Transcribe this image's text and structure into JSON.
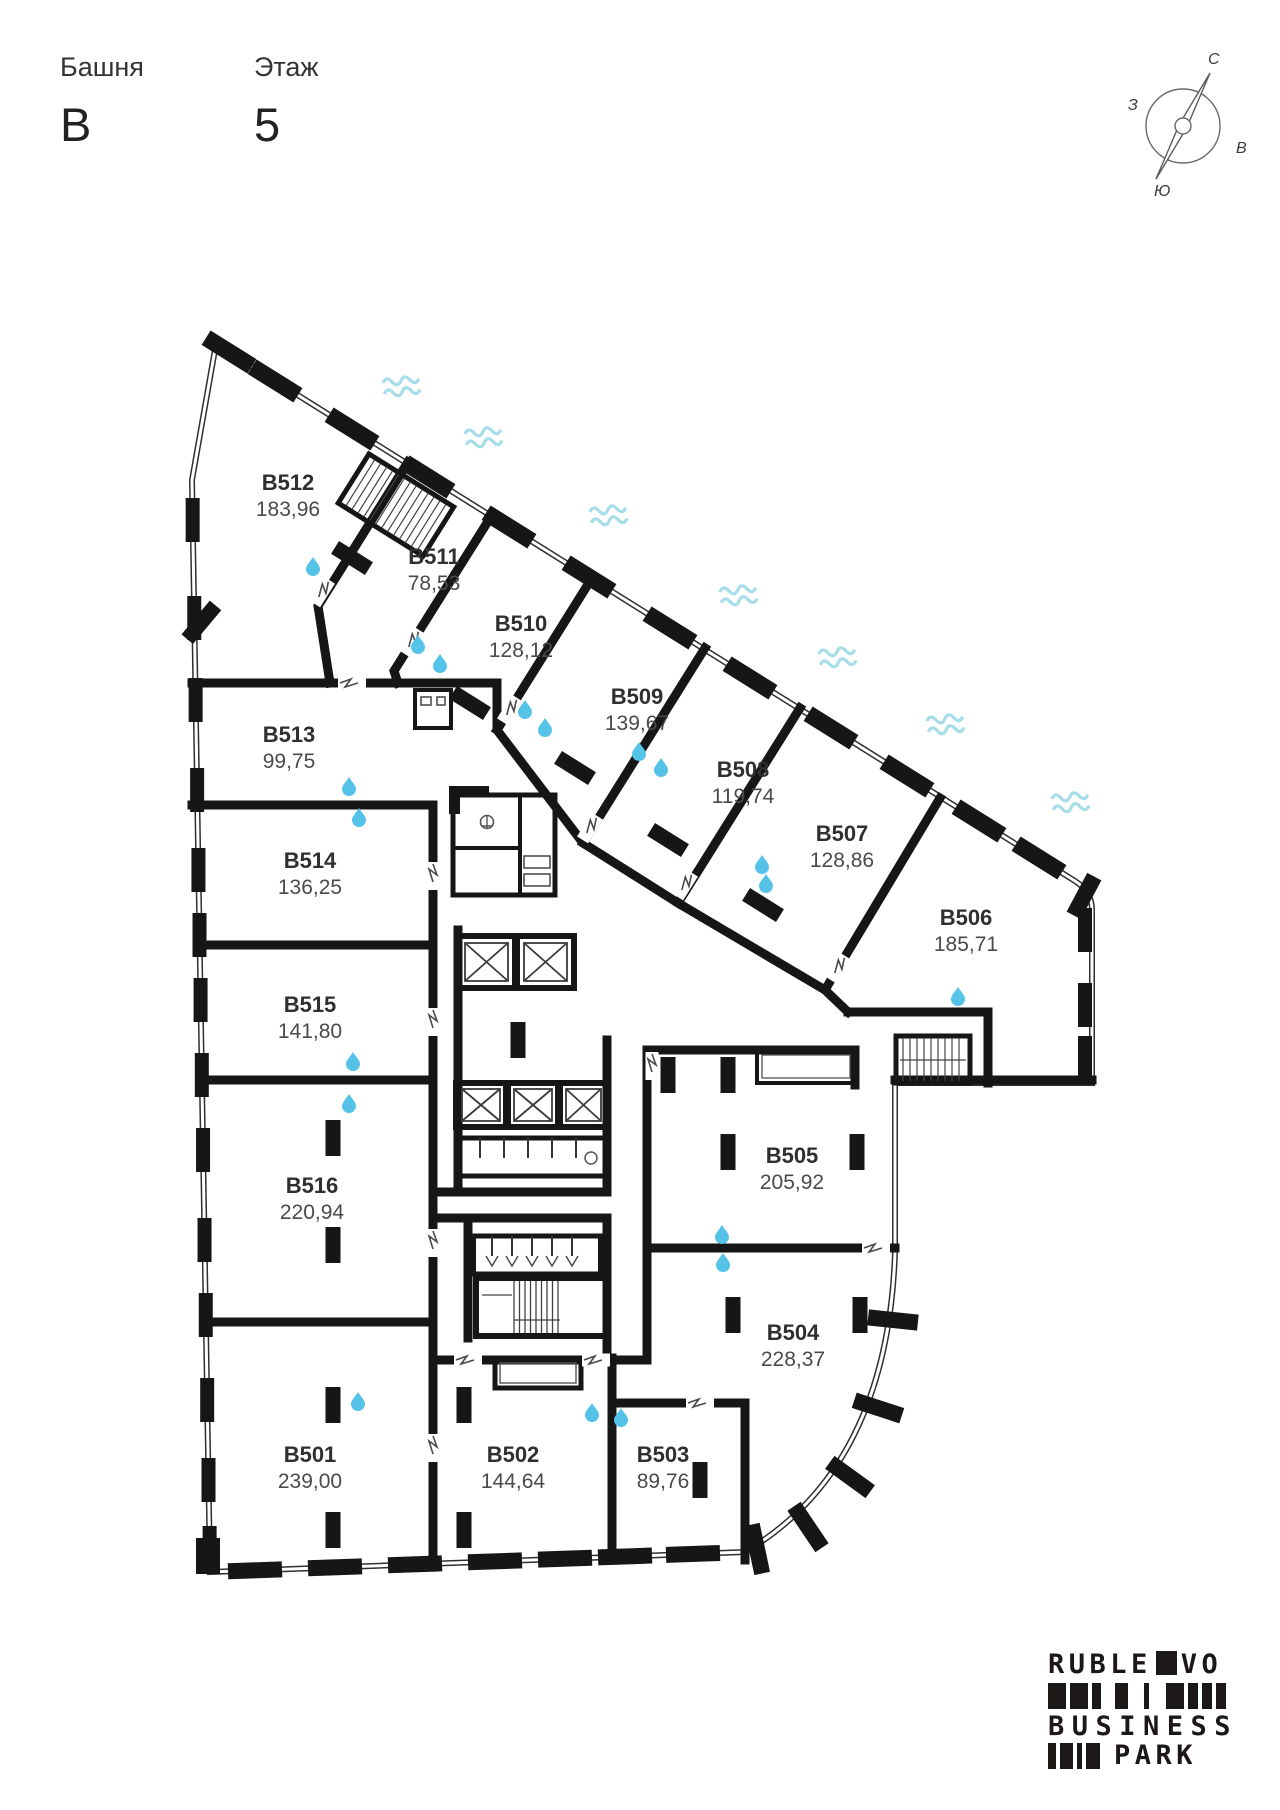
{
  "header": {
    "tower_label": "Башня",
    "tower_value": "В",
    "floor_label": "Этаж",
    "floor_value": "5"
  },
  "compass": {
    "north": "С",
    "east": "В",
    "south": "Ю",
    "west": "З"
  },
  "rooms": [
    {
      "id": "B501",
      "area": "239,00"
    },
    {
      "id": "B502",
      "area": "144,64"
    },
    {
      "id": "B503",
      "area": "89,76"
    },
    {
      "id": "B504",
      "area": "228,37"
    },
    {
      "id": "B505",
      "area": "205,92"
    },
    {
      "id": "B506",
      "area": "185,71"
    },
    {
      "id": "B507",
      "area": "128,86"
    },
    {
      "id": "B508",
      "area": "119,74"
    },
    {
      "id": "B509",
      "area": "139,67"
    },
    {
      "id": "B510",
      "area": "128,12"
    },
    {
      "id": "B511",
      "area": "78,53"
    },
    {
      "id": "B512",
      "area": "183,96"
    },
    {
      "id": "B513",
      "area": "99,75"
    },
    {
      "id": "B514",
      "area": "136,25"
    },
    {
      "id": "B515",
      "area": "141,80"
    },
    {
      "id": "B516",
      "area": "220,94"
    }
  ],
  "logo": {
    "line1_left": "RUBLE",
    "line1_right": "VO",
    "line2": "BUSINESS",
    "line3": "PARK"
  },
  "colors": {
    "wall": "#161616",
    "glaze": "#2f2f2f",
    "water_drop": "#55c3e8",
    "wave": "#a6dde8",
    "door_mark": "#4a4a4a"
  }
}
